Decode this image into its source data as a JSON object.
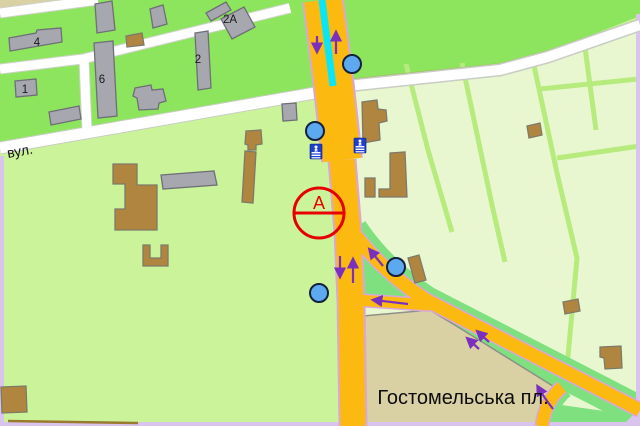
{
  "labels": {
    "street": "вул.",
    "square": "Гостомельська пл.",
    "marker_a": "A",
    "buildings": {
      "b4": "4",
      "b1": "1",
      "b6": "6",
      "b2": "2",
      "b2a": "2A"
    }
  },
  "icons": {
    "bus_stop": "blue-circle-stop-marker",
    "pedestrian_crossing": "blue-square-pedestrian-crossing",
    "one_way_arrow": "purple-direction-arrow",
    "route_marker": "red-circle-A-marker",
    "tram_line": "cyan-center-line"
  },
  "colors": {
    "area_green_bright": "#8CE55C",
    "area_green_light": "#CBF49A",
    "area_field_pale": "#E9F7D0",
    "field_path_green": "#B7EB7E",
    "junction_green": "#7EE07E",
    "road_orange": "#FCB90F",
    "road_casing_pink": "#DBA6DA",
    "road_white": "#FFFFFF",
    "tram_cyan": "#0AE6F5",
    "square_tan": "#D9D0A4",
    "building_gray": "#A7A7AF",
    "building_brown": "#B0853F",
    "stop_marker_blue": "#5DA9F0",
    "crossing_icon_blue": "#1E3FD0",
    "arrow_purple": "#7B2FBF",
    "marker_red": "#E60000",
    "map_edge_lavender": "#D9C4EE"
  }
}
